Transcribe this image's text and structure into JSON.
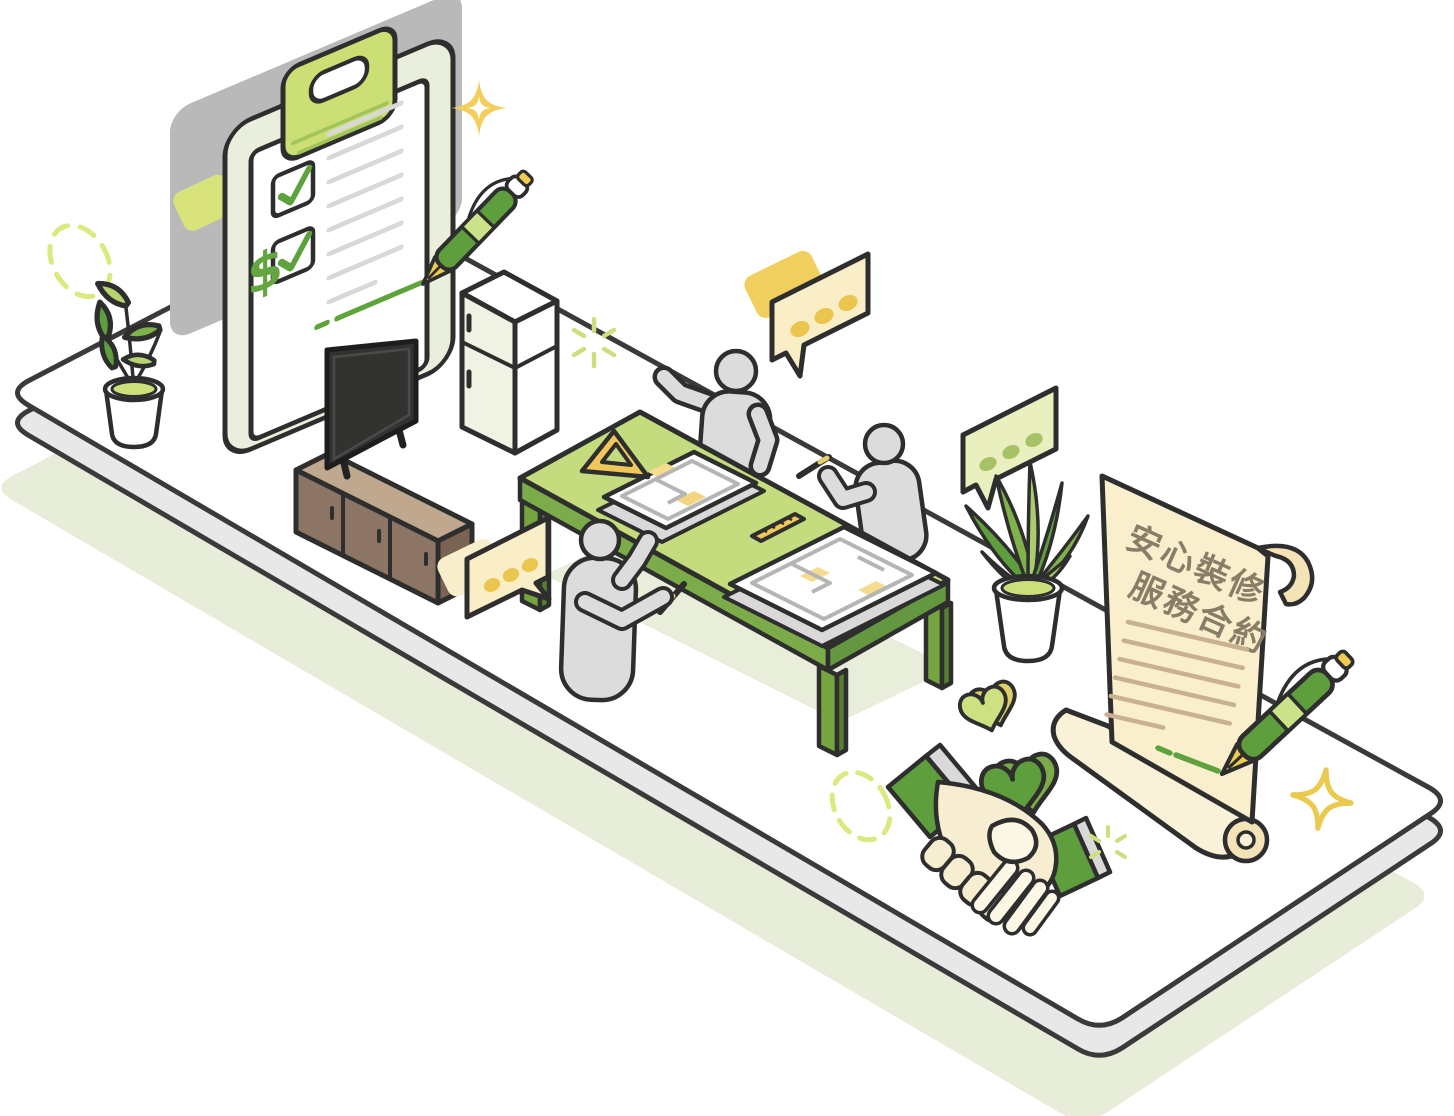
{
  "illustration": {
    "type": "isometric-illustration",
    "theme": "home renovation service: checklist, planning meeting, contract signing and handshake",
    "scroll": {
      "title_line1": "安心裝修",
      "title_line2": "服務合約",
      "body_lines": 6,
      "signed": true
    },
    "clipboard": {
      "currency_symbol": "$",
      "checked_items": 2,
      "text_lines": 8,
      "signed": true
    },
    "colors": {
      "outline": "#2e2e2e",
      "primary_green": "#5f9e3d",
      "leg_green": "#74a53f",
      "light_green": "#cbe288",
      "table_green": "#c4dc7e",
      "sage_board": "#e9efdc",
      "clip_green": "#ccdf74",
      "gold": "#eecb52",
      "bubble_cream": "#faeec6",
      "bubble_green": "#e9efbe",
      "scroll_cream": "#f9efcd",
      "scroll_curl": "#f3e3b6",
      "scroll_text": "#8b7c68",
      "scroll_line": "#c8b190",
      "people_gray": "#dcdcdc",
      "platform_top": "#ffffff",
      "platform_side": "#e8e8e8",
      "platform_shadow": "#e7edd8",
      "backdrop_gray": "#b9b9b9",
      "cabinet_brown": "#8d7565",
      "cabinet_top": "#c0a88f",
      "doc_gray": "#d9d9d9",
      "plan_line": "#b5b5b5",
      "plan_yellow": "#f6dc8e",
      "hand_cream": "#f7eed2",
      "hand_light": "#fdf7e6"
    },
    "objects": [
      "clipboard-checklist",
      "fountain-pen",
      "sparkle",
      "potted-plant",
      "tv-console",
      "television",
      "refrigerator",
      "meeting-table",
      "floor-plan-document",
      "ruler",
      "set-square",
      "person",
      "speech-bubble",
      "contract-scroll",
      "handshake",
      "heart"
    ]
  }
}
